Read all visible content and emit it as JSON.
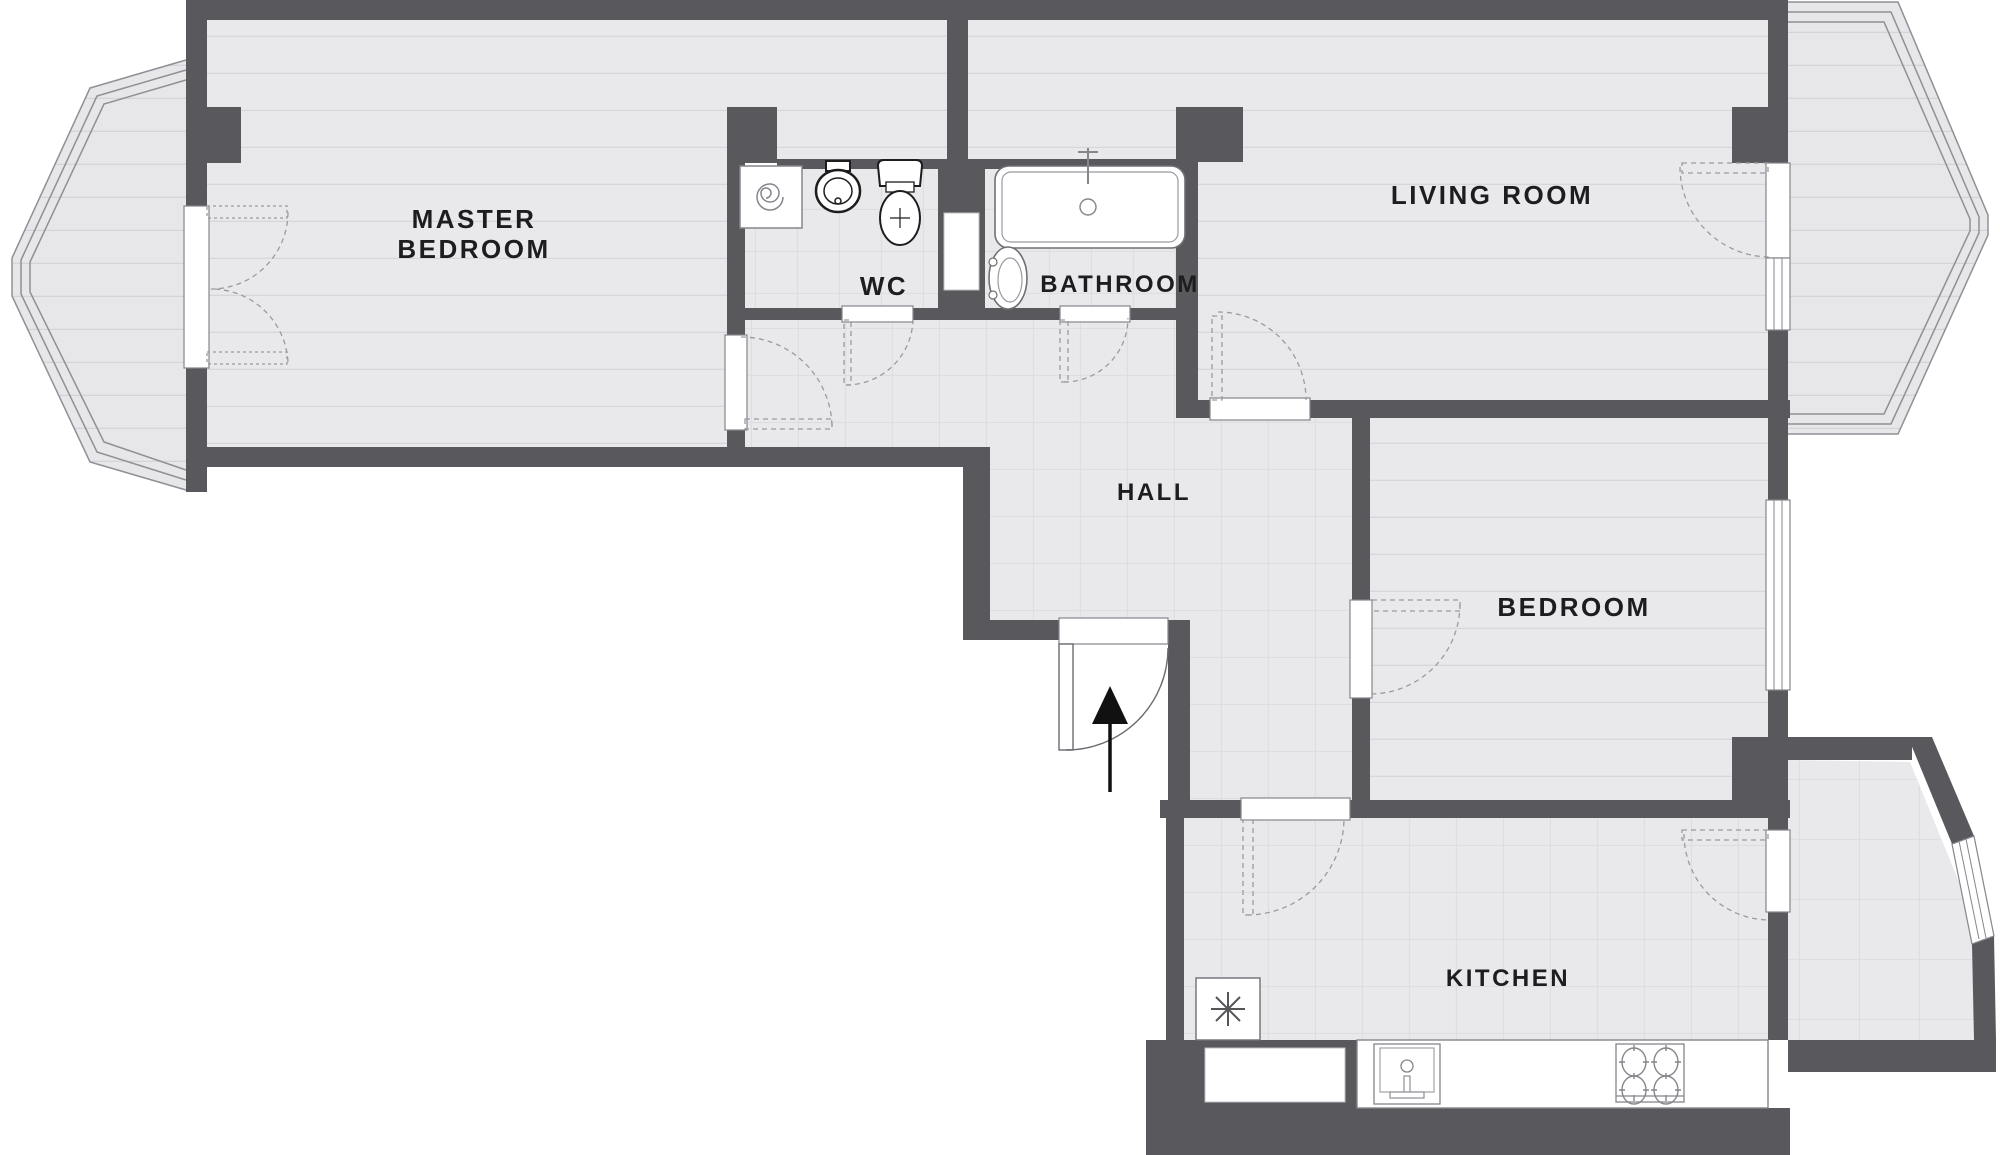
{
  "document": {
    "type": "apartment-floor-plan",
    "colors": {
      "wall": "#58585d",
      "floor": "#e9e9ec",
      "plank_line": "#d7d7db",
      "tile_line": "#dedee1",
      "fixture_stroke": "#85858c",
      "label_text": "#1d1d1f",
      "background": "#ffffff"
    },
    "rooms": {
      "master_bedroom": {
        "label_line1": "MASTER",
        "label_line2": "BEDROOM"
      },
      "wc": {
        "label": "WC"
      },
      "bathroom": {
        "label": "BATHROOM"
      },
      "living_room": {
        "label": "LIVING ROOM"
      },
      "hall": {
        "label": "HALL"
      },
      "bedroom": {
        "label": "BEDROOM"
      },
      "kitchen": {
        "label": "KITCHEN"
      }
    },
    "icons": {
      "entrance_arrow": "up-arrow-into-hall",
      "fridge_symbol": "asterisk",
      "washing_machine_symbol": "spiral"
    },
    "fixtures": [
      "washing-machine",
      "wc-sink",
      "toilet",
      "bathtub",
      "bidet",
      "fridge",
      "kitchen-sink",
      "stove",
      "kitchen-counter"
    ],
    "windows": [
      "left-bay-window",
      "right-bay-window",
      "living-room-window",
      "bedroom-window",
      "balcony-slant-window"
    ],
    "doors": [
      "french-balcony-doors",
      "master-bedroom-door",
      "wc-door",
      "bathroom-door",
      "living-room-door",
      "entrance-door",
      "bedroom-door",
      "kitchen-door",
      "kitchen-balcony-door"
    ]
  }
}
